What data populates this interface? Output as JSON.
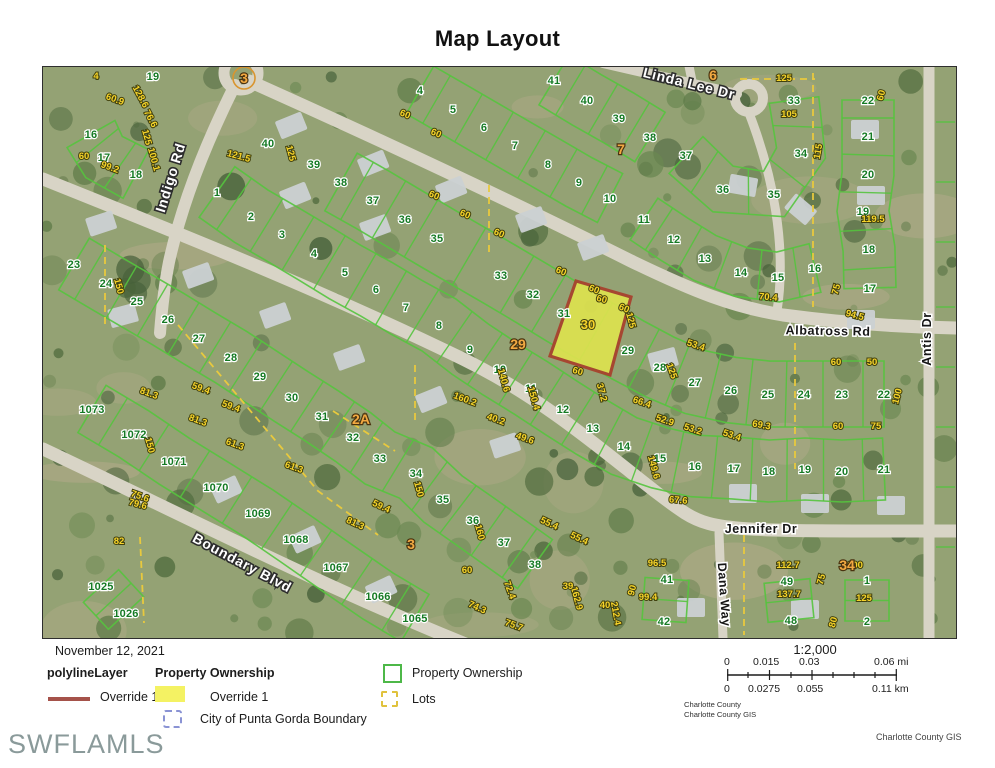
{
  "title": "Map Layout",
  "watermark": "SWFLAMLS",
  "footer": {
    "date": "November 12, 2021",
    "polyline_header": "polylineLayer",
    "ownership_header": "Property Ownership",
    "override1_line": "Override 1",
    "override1_fill": "Override 1",
    "city_boundary": "City of Punta Gorda Boundary",
    "ownership2": "Property Ownership",
    "lots": "Lots",
    "scale_ratio": "1:2,000",
    "mi": [
      "0",
      "0.015",
      "0.03",
      "0.06 mi"
    ],
    "km": [
      "0",
      "0.0275",
      "0.055",
      "0.11 km"
    ],
    "credits1": "Charlotte County",
    "credits2": "Charlotte County GIS",
    "credit_right": "Charlotte County GIS"
  },
  "map": {
    "colors": {
      "base": "#94a274",
      "sand": "#b5ab8c",
      "road": "#d8d4c6",
      "parcel": "#55c43e",
      "dash": "#e8c93e",
      "highlight_fill": "#dde24f",
      "highlight_stroke": "#a8402c",
      "tree1": "#4f6a3d",
      "tree2": "#5d7a47",
      "tree3": "#46603a",
      "tree4": "#6b8852",
      "house": "#cbd1d3"
    },
    "streets": [
      {
        "n": "Indigo Rd",
        "x": 132,
        "y": 108,
        "r": -73,
        "s": "major"
      },
      {
        "n": "Linda Lee Dr",
        "x": 645,
        "y": 17,
        "r": 14,
        "s": "major"
      },
      {
        "n": "Albatross Rd",
        "x": 785,
        "y": 264,
        "r": 1,
        "s": "minor"
      },
      {
        "n": "Antis Dr",
        "x": 888,
        "y": 268,
        "r": -90,
        "s": "minor"
      },
      {
        "n": "Jennifer Dr",
        "x": 718,
        "y": 462,
        "r": 0,
        "s": "minor"
      },
      {
        "n": "Dana Way",
        "x": 677,
        "y": 524,
        "r": 86,
        "s": "minor"
      },
      {
        "n": "Boundary Blvd",
        "x": 197,
        "y": 496,
        "r": 28,
        "s": "major"
      }
    ],
    "highlight": {
      "points": "533,214 588,230 567,308 507,289",
      "label": "30",
      "lx": 545,
      "ly": 262
    },
    "rows": [
      {
        "depth": 58,
        "pts": [
          [
            "41",
            511,
            13
          ],
          [
            "40",
            544,
            33
          ],
          [
            "39",
            576,
            51
          ],
          [
            "38",
            607,
            70
          ]
        ]
      },
      {
        "depth": 55,
        "pts": [
          [
            "4",
            377,
            23
          ],
          [
            "5",
            410,
            42
          ],
          [
            "6",
            441,
            60
          ],
          [
            "7",
            472,
            78
          ],
          [
            "8",
            505,
            97
          ],
          [
            "9",
            536,
            115
          ],
          [
            "10",
            567,
            131
          ]
        ]
      },
      {
        "depth": 66,
        "pts": [
          [
            "38",
            298,
            115
          ],
          [
            "37",
            330,
            133
          ],
          [
            "36",
            362,
            152
          ],
          [
            "35",
            394,
            171
          ],
          [
            "33",
            458,
            208
          ],
          [
            "32",
            490,
            227
          ],
          [
            "31",
            521,
            246
          ],
          [
            "29",
            585,
            283
          ],
          [
            "28",
            617,
            300
          ],
          [
            "27",
            652,
            315
          ],
          [
            "26",
            688,
            323
          ],
          [
            "25",
            725,
            327
          ],
          [
            "24",
            761,
            327
          ],
          [
            "23",
            799,
            327
          ],
          [
            "22",
            841,
            327
          ]
        ]
      },
      {
        "depth": 62,
        "pts": [
          [
            "1",
            174,
            125
          ],
          [
            "2",
            208,
            149
          ],
          [
            "3",
            239,
            167
          ],
          [
            "4",
            271,
            186
          ],
          [
            "5",
            302,
            205
          ],
          [
            "6",
            333,
            222
          ],
          [
            "7",
            363,
            240
          ],
          [
            "8",
            396,
            258
          ],
          [
            "9",
            427,
            282
          ],
          [
            "10",
            457,
            302
          ],
          [
            "11",
            488,
            321
          ],
          [
            "12",
            520,
            342
          ],
          [
            "13",
            550,
            361
          ],
          [
            "14",
            581,
            379
          ],
          [
            "15",
            617,
            391
          ],
          [
            "16",
            652,
            399
          ],
          [
            "17",
            691,
            401
          ],
          [
            "18",
            726,
            404
          ],
          [
            "19",
            762,
            402
          ],
          [
            "20",
            799,
            404
          ],
          [
            "21",
            841,
            402
          ]
        ]
      },
      {
        "depth": 60,
        "pts": [
          [
            "23",
            31,
            197
          ],
          [
            "24",
            63,
            216
          ],
          [
            "25",
            94,
            234
          ],
          [
            "26",
            125,
            252
          ],
          [
            "27",
            156,
            271
          ],
          [
            "28",
            188,
            290
          ],
          [
            "29",
            217,
            309
          ],
          [
            "30",
            249,
            330
          ],
          [
            "31",
            279,
            349
          ],
          [
            "32",
            310,
            370
          ],
          [
            "33",
            337,
            391
          ],
          [
            "34",
            373,
            406
          ],
          [
            "35",
            400,
            432
          ],
          [
            "36",
            430,
            453
          ],
          [
            "37",
            461,
            475
          ],
          [
            "38",
            492,
            497
          ]
        ]
      },
      {
        "depth": 55,
        "pts": [
          [
            "1073",
            49,
            342
          ],
          [
            "1072",
            91,
            367
          ],
          [
            "1071",
            131,
            394
          ],
          [
            "1070",
            173,
            420
          ],
          [
            "1069",
            215,
            446
          ],
          [
            "1068",
            253,
            472
          ],
          [
            "1067",
            293,
            500
          ],
          [
            "1066",
            335,
            529
          ],
          [
            "1065",
            372,
            551
          ]
        ]
      },
      {
        "depth": 48,
        "pts": [
          [
            "1025",
            58,
            519
          ],
          [
            "1026",
            83,
            546
          ]
        ]
      },
      {
        "depth": 55,
        "pts": [
          [
            "16",
            48,
            67
          ],
          [
            "17",
            61,
            90
          ],
          [
            "18",
            93,
            107
          ]
        ]
      },
      {
        "depth": 52,
        "pts": [
          [
            "22",
            825,
            33
          ],
          [
            "21",
            825,
            69
          ],
          [
            "20",
            825,
            107
          ],
          [
            "19",
            820,
            144
          ],
          [
            "18",
            826,
            182
          ],
          [
            "17",
            827,
            221
          ]
        ]
      },
      {
        "depth": 50,
        "pts": [
          [
            "11",
            601,
            152
          ],
          [
            "12",
            631,
            172
          ],
          [
            "13",
            662,
            191
          ],
          [
            "14",
            698,
            205
          ],
          [
            "15",
            735,
            210
          ],
          [
            "16",
            772,
            201
          ]
        ]
      },
      {
        "depth": 50,
        "pts": [
          [
            "37",
            643,
            88
          ],
          [
            "36",
            680,
            122
          ],
          [
            "35",
            731,
            127
          ],
          [
            "34",
            758,
            86
          ],
          [
            "33",
            751,
            33
          ]
        ]
      },
      {
        "depth": 44,
        "pts": [
          [
            "41",
            624,
            512
          ],
          [
            "42",
            621,
            554
          ]
        ]
      },
      {
        "depth": 46,
        "pts": [
          [
            "49",
            744,
            514
          ],
          [
            "48",
            748,
            553
          ]
        ]
      },
      {
        "depth": 44,
        "pts": [
          [
            "1",
            824,
            513
          ],
          [
            "2",
            824,
            554
          ]
        ]
      }
    ],
    "extra_green": [
      [
        "19",
        110,
        9
      ],
      [
        "40",
        225,
        76
      ],
      [
        "39",
        271,
        97
      ]
    ],
    "orange": [
      [
        "3",
        201,
        11,
        1
      ],
      [
        "6",
        670,
        8,
        0
      ],
      [
        "7",
        578,
        82,
        0
      ],
      [
        "29",
        475,
        277,
        0
      ],
      [
        "2A",
        318,
        352,
        0
      ],
      [
        "3",
        368,
        477,
        0
      ],
      [
        "34",
        804,
        498,
        0
      ]
    ],
    "yellow": [
      [
        "60.9",
        71,
        32,
        20
      ],
      [
        "128.6",
        95,
        28,
        62
      ],
      [
        "76.6",
        105,
        50,
        62
      ],
      [
        "125",
        101,
        68,
        75
      ],
      [
        "100.1",
        108,
        90,
        75
      ],
      [
        "60",
        41,
        89,
        0
      ],
      [
        "99.2",
        66,
        100,
        20
      ],
      [
        "121.5",
        195,
        89,
        15
      ],
      [
        "125",
        245,
        84,
        75
      ],
      [
        "60",
        361,
        47,
        22
      ],
      [
        "60",
        392,
        66,
        22
      ],
      [
        "60",
        390,
        128,
        22
      ],
      [
        "60",
        421,
        147,
        22
      ],
      [
        "60",
        455,
        166,
        22
      ],
      [
        "60",
        517,
        204,
        22
      ],
      [
        "60",
        550,
        222,
        22
      ],
      [
        "60",
        580,
        241,
        22
      ],
      [
        "60",
        558,
        232,
        15
      ],
      [
        "60",
        534,
        304,
        15
      ],
      [
        "125",
        585,
        251,
        75
      ],
      [
        "125",
        626,
        302,
        70
      ],
      [
        "53.4",
        652,
        278,
        18
      ],
      [
        "66.4",
        598,
        335,
        18
      ],
      [
        "52.9",
        621,
        353,
        18
      ],
      [
        "53.2",
        649,
        362,
        18
      ],
      [
        "53.4",
        688,
        368,
        18
      ],
      [
        "69.3",
        718,
        358,
        10
      ],
      [
        "60",
        793,
        295,
        0
      ],
      [
        "50",
        829,
        295,
        0
      ],
      [
        "60",
        795,
        359,
        0
      ],
      [
        "75",
        833,
        359,
        0
      ],
      [
        "100",
        857,
        327,
        -75
      ],
      [
        "149.6",
        608,
        398,
        75
      ],
      [
        "67.6",
        635,
        433,
        5
      ],
      [
        "119.5",
        830,
        152,
        0
      ],
      [
        "115",
        778,
        82,
        -80
      ],
      [
        "105",
        746,
        47,
        0
      ],
      [
        "125",
        741,
        11,
        0
      ],
      [
        "94.5",
        811,
        248,
        15
      ],
      [
        "70.4",
        725,
        230,
        5
      ],
      [
        "75",
        796,
        220,
        -75
      ],
      [
        "60",
        841,
        26,
        -75
      ],
      [
        "150",
        73,
        217,
        75
      ],
      [
        "59.4",
        157,
        321,
        20
      ],
      [
        "59.4",
        187,
        339,
        20
      ],
      [
        "81.3",
        105,
        326,
        20
      ],
      [
        "81.3",
        154,
        353,
        20
      ],
      [
        "61.3",
        191,
        377,
        20
      ],
      [
        "61.3",
        250,
        400,
        20
      ],
      [
        "75.6",
        96,
        429,
        20
      ],
      [
        "150",
        104,
        376,
        75
      ],
      [
        "82",
        76,
        474,
        0
      ],
      [
        "79.6",
        94,
        437,
        15
      ],
      [
        "150",
        373,
        420,
        75
      ],
      [
        "160",
        434,
        463,
        75
      ],
      [
        "59.4",
        337,
        439,
        25
      ],
      [
        "81.3",
        311,
        456,
        25
      ],
      [
        "55.4",
        505,
        456,
        25
      ],
      [
        "55.4",
        535,
        471,
        25
      ],
      [
        "72.4",
        464,
        521,
        70
      ],
      [
        "74.3",
        433,
        540,
        25
      ],
      [
        "75.7",
        470,
        558,
        20
      ],
      [
        "162.9",
        531,
        529,
        75
      ],
      [
        "212.4",
        570,
        544,
        80
      ],
      [
        "60",
        424,
        503,
        0
      ],
      [
        "90",
        592,
        521,
        -75
      ],
      [
        "39",
        525,
        519,
        0
      ],
      [
        "40",
        562,
        538,
        0
      ],
      [
        "96.5",
        614,
        496,
        0
      ],
      [
        "99.4",
        605,
        530,
        0
      ],
      [
        "112.7",
        745,
        498,
        0
      ],
      [
        "137.7",
        746,
        527,
        0
      ],
      [
        "100",
        812,
        498,
        0
      ],
      [
        "125",
        821,
        531,
        0
      ],
      [
        "75",
        781,
        510,
        -75
      ],
      [
        "80",
        793,
        553,
        -75
      ],
      [
        "140.6",
        458,
        311,
        75
      ],
      [
        "150.4",
        488,
        329,
        75
      ],
      [
        "160.2",
        421,
        332,
        20
      ],
      [
        "40.2",
        452,
        352,
        20
      ],
      [
        "49.6",
        481,
        371,
        20
      ],
      [
        "37.2",
        556,
        323,
        75
      ],
      [
        "4",
        53,
        9,
        0
      ]
    ]
  }
}
